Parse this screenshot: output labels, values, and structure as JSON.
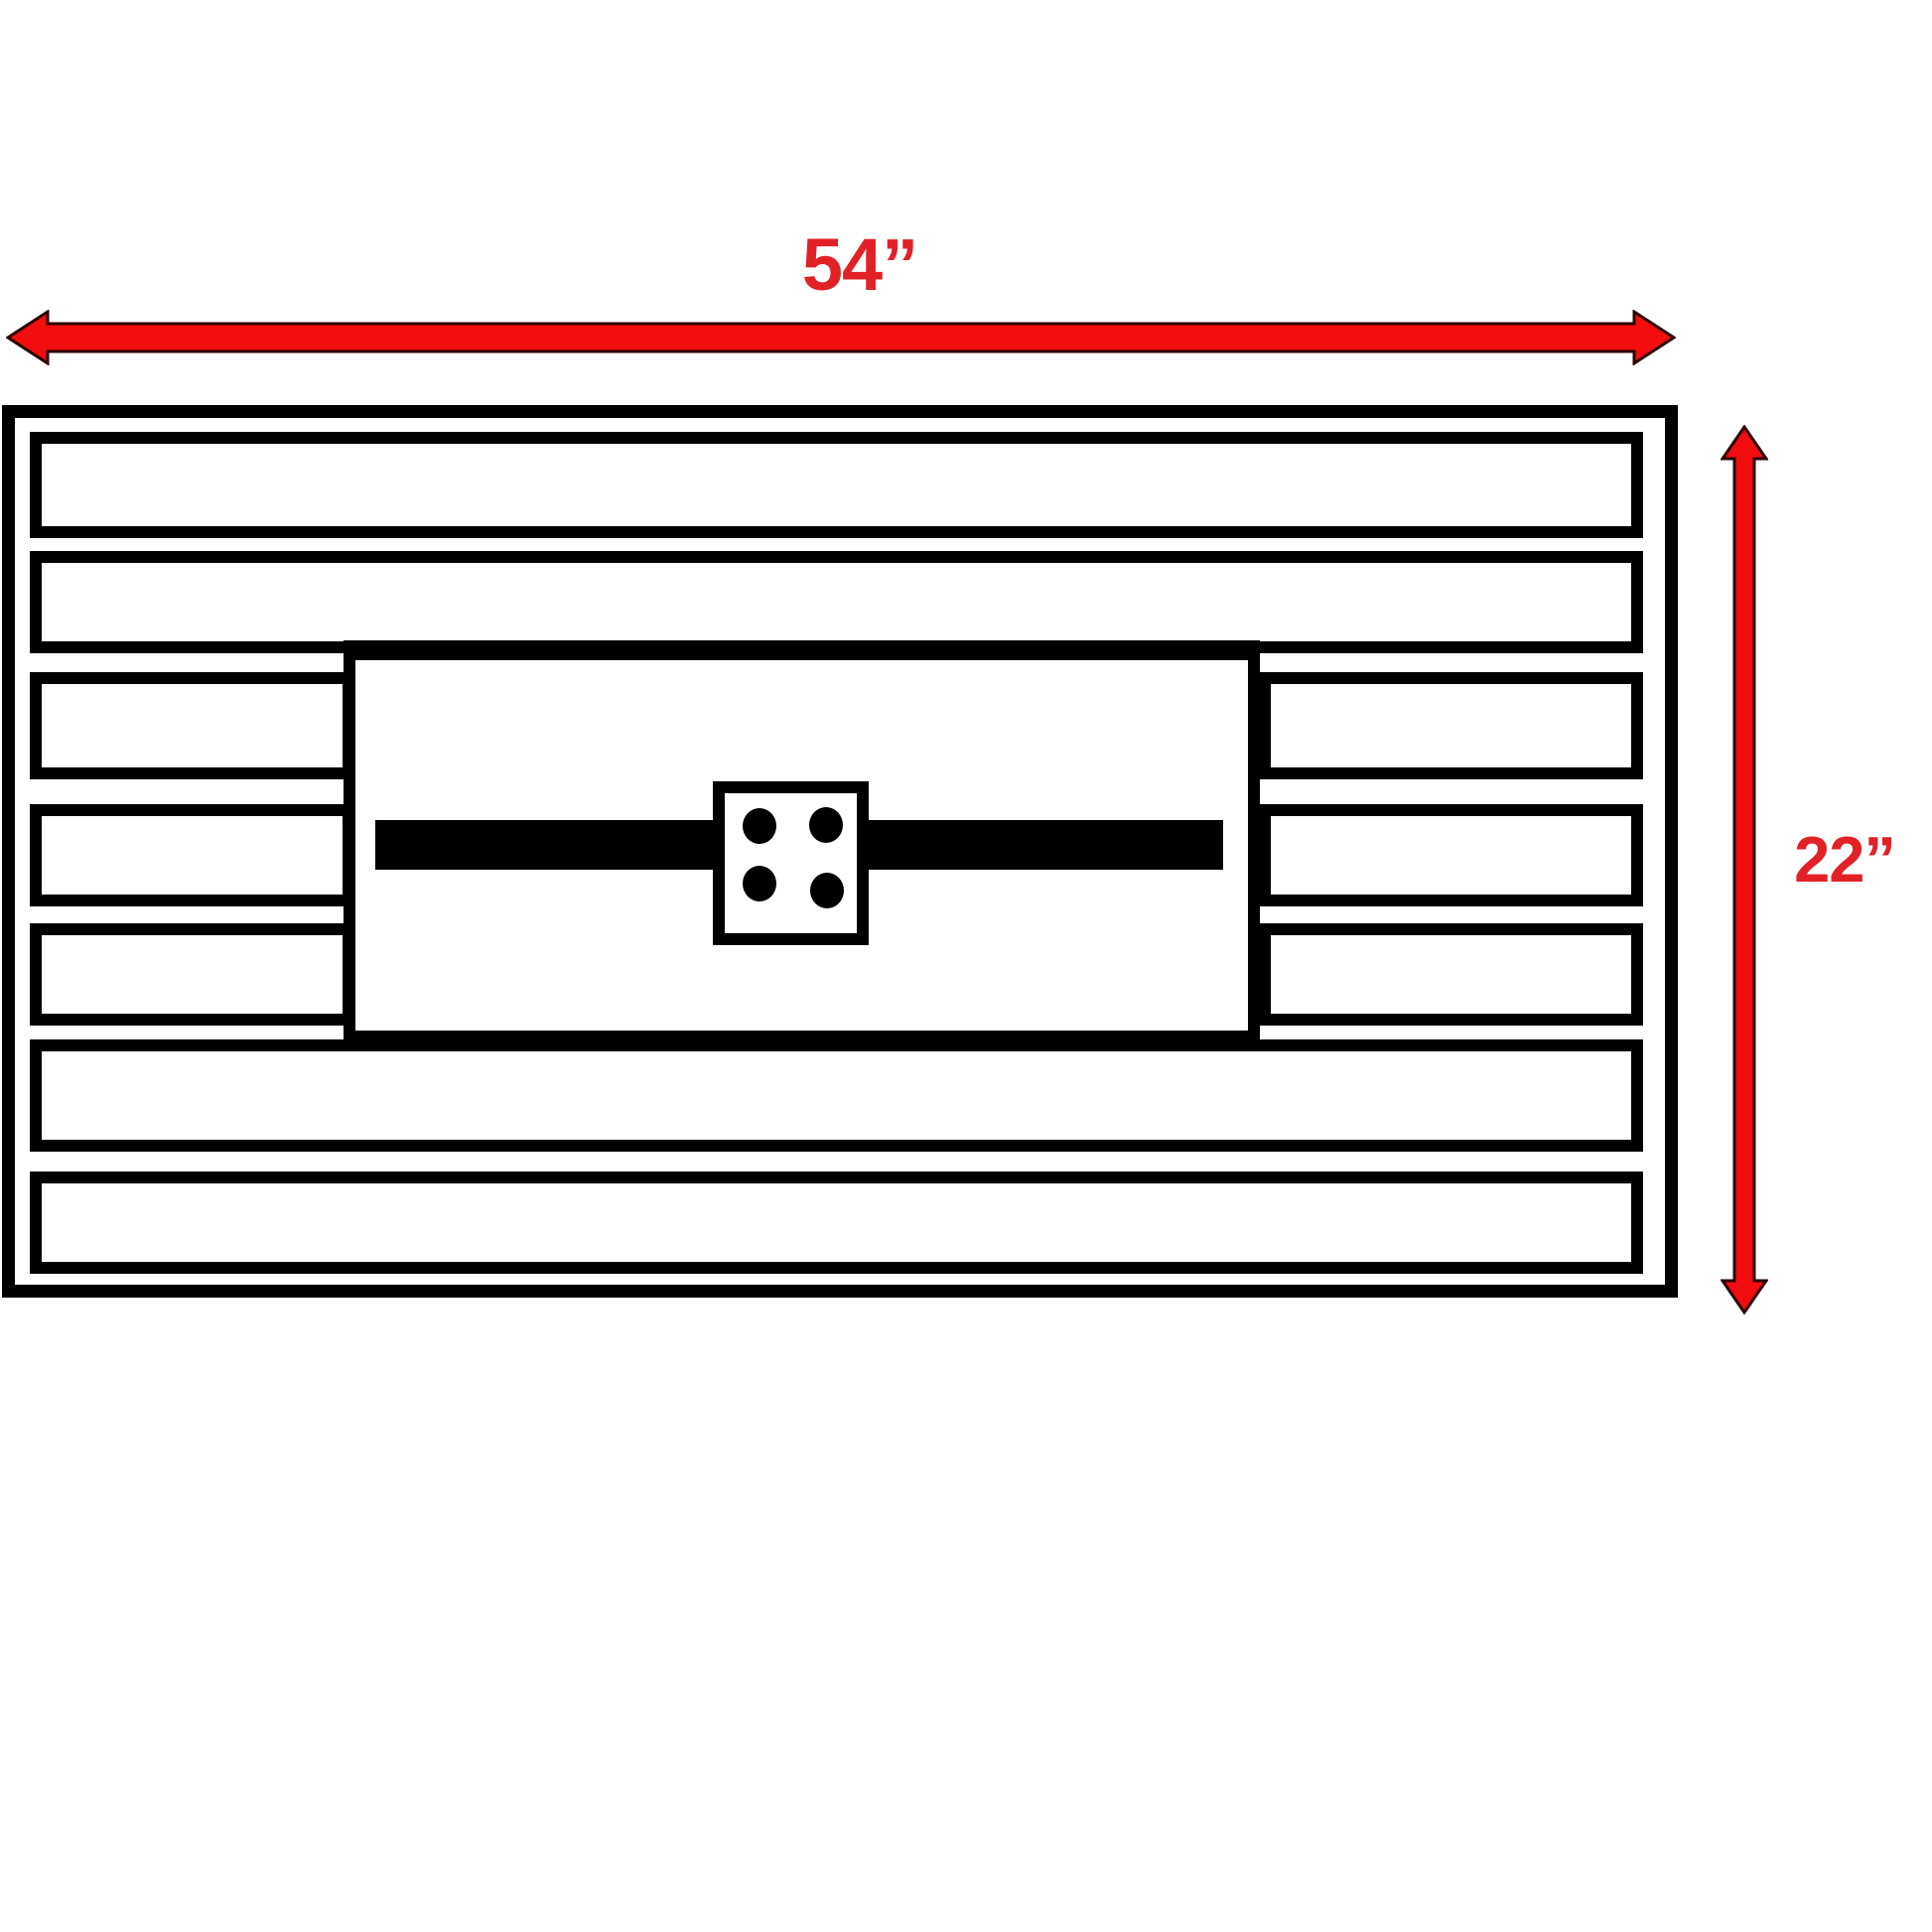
{
  "diagram": {
    "title": "Table top plan view with overall dimensions",
    "dimensions": {
      "width_label": "54”",
      "height_label": "22”"
    },
    "parts": {
      "slat_rows_total": 7,
      "full_width_rows": [
        1,
        2,
        6,
        7
      ],
      "split_rows_around_panel": [
        3,
        4,
        5
      ],
      "center_panel": "recessed burner panel",
      "burner_bar": "horizontal burner bar",
      "mount_plate_bolt_count": 4
    },
    "colors": {
      "line_black": "#000000",
      "background": "#ffffff",
      "arrow_red": "#f20d0e",
      "arrow_outline": "#2d0203",
      "label_red": "#e22127"
    }
  }
}
